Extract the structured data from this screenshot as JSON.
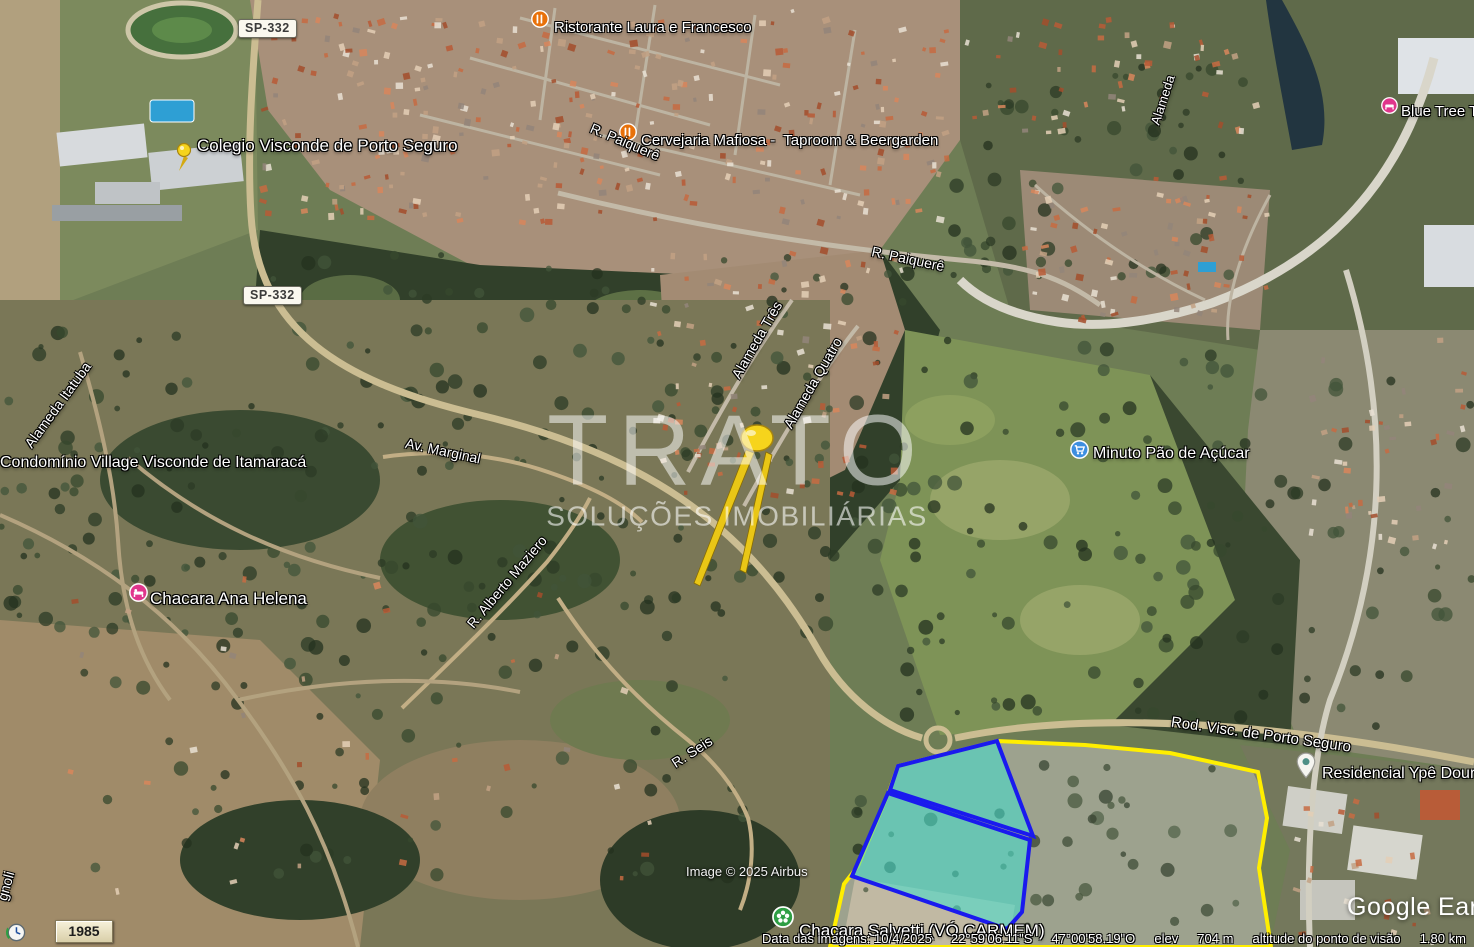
{
  "app": {
    "watermark_line1": "TRATO",
    "watermark_line2": "SOLUÇÕES IMOBILIÁRIAS",
    "logo": "Google Earth",
    "copyright": "Image © 2025 Airbus"
  },
  "time_control": {
    "year": "1985"
  },
  "shields": {
    "sp332": "SP-332"
  },
  "poi": {
    "ristorante": {
      "text": "Ristorante Laura e Francesco",
      "icon": "restaurant-icon"
    },
    "colegio": {
      "text": "Colegio Visconde de Porto Seguro",
      "icon": "pushpin-icon"
    },
    "cervejaria": {
      "text": "Cervejaria Mafiosa -  Taproom & Beergarden",
      "icon": "restaurant-icon"
    },
    "blue_tree": {
      "text": "Blue Tree Tow",
      "icon": "lodging-icon"
    },
    "condominio": {
      "text": "Condomínio Village Visconde de Itamaracá",
      "icon": "none"
    },
    "chacara_ana": {
      "text": "Chacara Ana Helena",
      "icon": "lodging-icon"
    },
    "minuto": {
      "text": "Minuto Pão de Açúcar",
      "icon": "supermarket-icon"
    },
    "residencial": {
      "text": "Residencial Ypê Doura",
      "icon": "place-pin-icon"
    },
    "chacara_salvetti": {
      "text": "Chacara Salvetti (VÓ CARMEM)",
      "icon": "park-flower-icon"
    }
  },
  "roads": {
    "paiquere_a": "R. Paiquerê",
    "paiquere_b": "R. Paiquerê",
    "alameda_tres": "Alameda Três",
    "alameda_quatro": "Alameda Quatro",
    "alameda_itatuba": "Alameda Itatuba",
    "alameda_far": "Alameda",
    "av_marginal": "Av. Marginal",
    "alberto_maziero": "R. Alberto Maziero",
    "r_seis": "R. Seis",
    "rod_visconde": "Rod. Visc. de Porto Seguro",
    "gnoli": "gnoli"
  },
  "status_bar": {
    "imagery_date": "Data das imagens: 10/4/2025",
    "latitude": "22°59'06.11\"S",
    "longitude": "47°00'58.19\"O",
    "elev_label": "elev",
    "elevation": "704 m",
    "view_alt_label": "altitude do ponto de visão",
    "view_altitude": "1.80 km"
  },
  "overlay": {
    "property_outline_color": "#ffee00",
    "parcel_fill_color": "#40e0d0",
    "parcel_stroke_color": "#1a1aee"
  }
}
